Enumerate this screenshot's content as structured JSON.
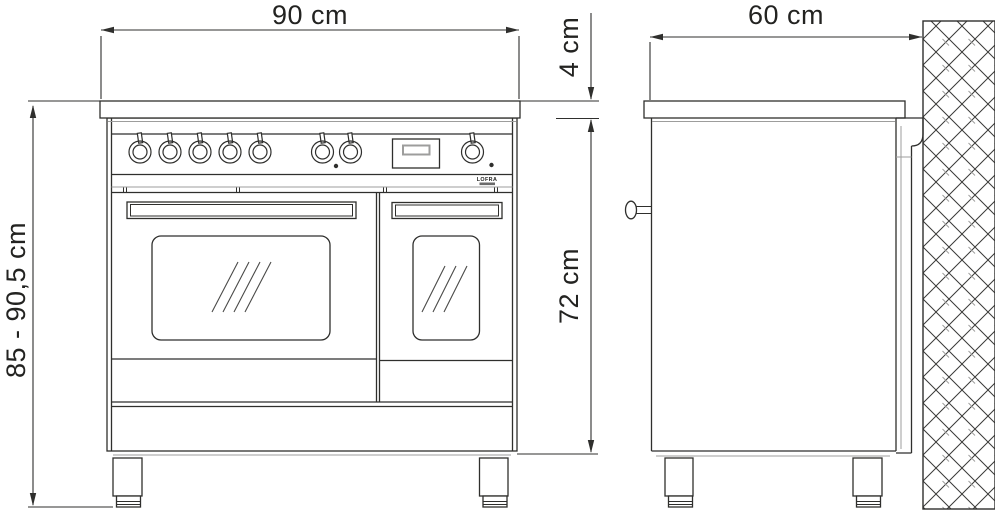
{
  "diagram": {
    "brand": "LOFRA",
    "views": {
      "front": {
        "width_label": "90 cm",
        "worktop_thickness_label": "4 cm",
        "overall_height_label": "85 - 90,5 cm",
        "body_height_label": "72 cm"
      },
      "side": {
        "depth_label": "60 cm"
      }
    },
    "colors": {
      "line": "#2f2f2d",
      "secondary_line": "#9d9d9c",
      "background": "#ffffff"
    }
  }
}
